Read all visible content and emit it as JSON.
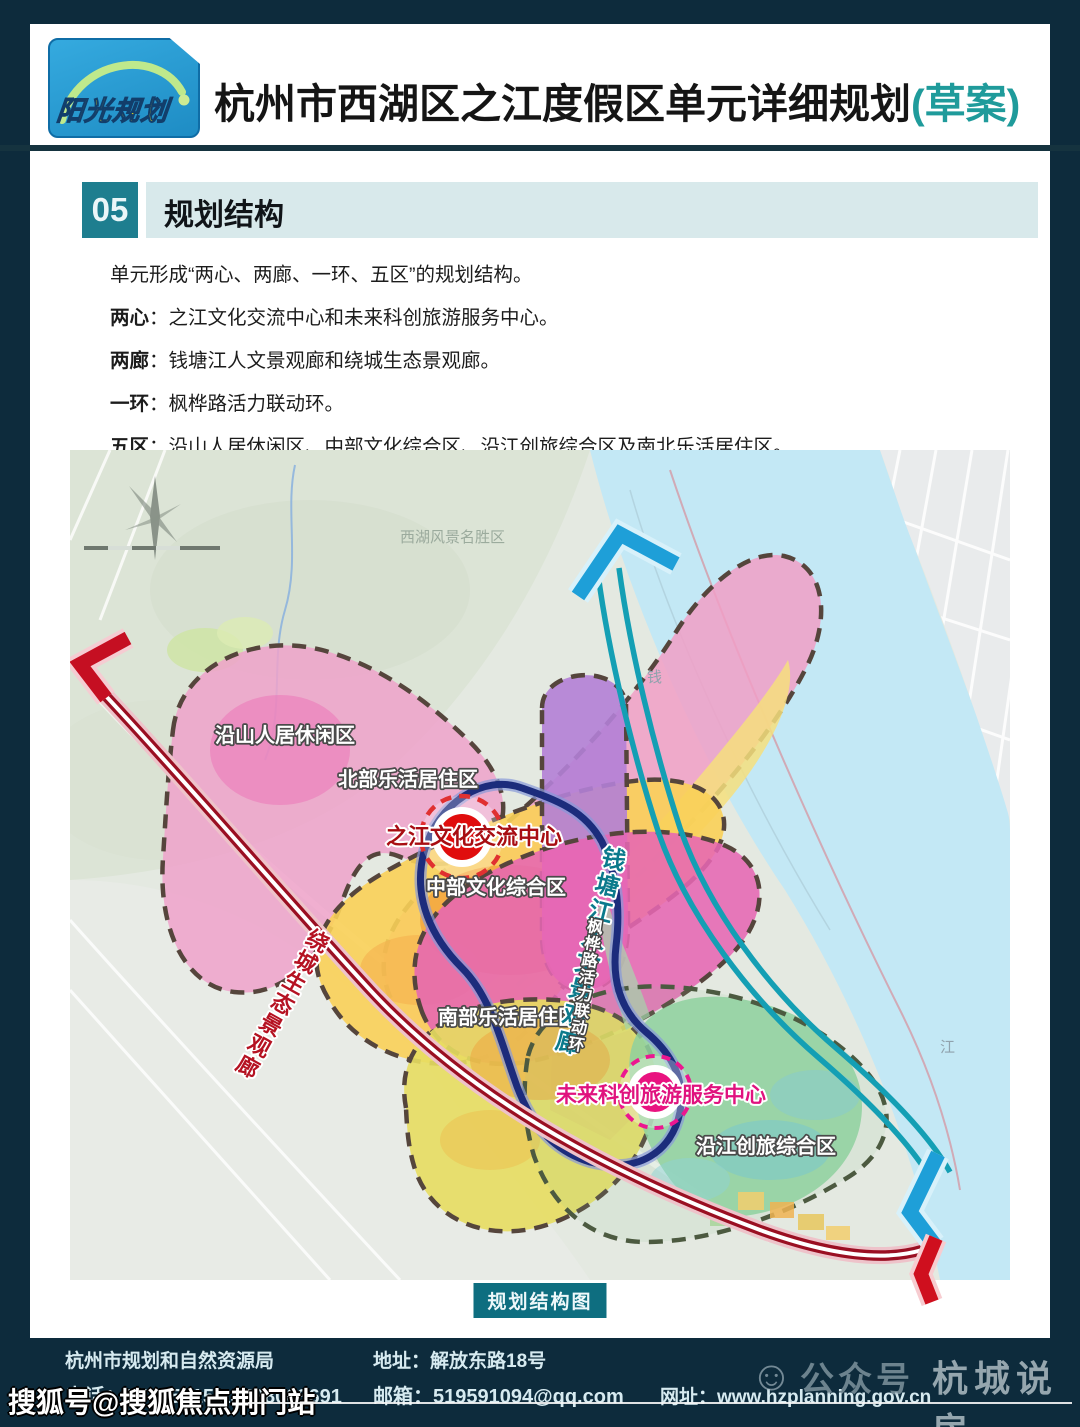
{
  "header": {
    "logo_text": "阳光规划",
    "title": "杭州市西湖区之江度假区单元详细规划",
    "title_suffix": "(草案)"
  },
  "section": {
    "number": "05",
    "title": "规划结构"
  },
  "intro": {
    "line1": "单元形成“两心、两廊、一环、五区”的规划结构。",
    "items": [
      {
        "term": "两心",
        "desc": "：之江文化交流中心和未来科创旅游服务中心。"
      },
      {
        "term": "两廊",
        "desc": "：钱塘江人文景观廊和绕城生态景观廊。"
      },
      {
        "term": "一环",
        "desc": "：枫桦路活力联动环。"
      },
      {
        "term": "五区",
        "desc": "：沿山人居休闲区、中部文化综合区、沿江创旅综合区及南北乐活居住区。"
      }
    ]
  },
  "map": {
    "caption": "规划结构图",
    "labels": {
      "scenic_area": "西湖风景名胜区",
      "river_char1": "钱",
      "river_char2": "江",
      "zone_yanshan": "沿山人居休闲区",
      "zone_beibu": "北部乐活居住区",
      "zone_zhongbu": "中部文化综合区",
      "zone_nanbu": "南部乐活居住区",
      "zone_yanjiang": "沿江创旅综合区",
      "center_zhijiang": "之江文化交流中心",
      "center_weilai": "未来科创旅游服务中心",
      "corridor_qiantang": "钱塘江人文景观廊",
      "corridor_raocheng": "绕城生态景观廊",
      "ring_fenghua": "枫桦路活力联动环"
    },
    "colors": {
      "river": "#c3e8f5",
      "zone_pink": "#f19fc6",
      "zone_yellow": "#f9d058",
      "zone_orange": "#f2a03a",
      "zone_purple": "#b37fd6",
      "zone_magenta": "#e667b3",
      "zone_green": "#8fd2a0",
      "corridor_teal": "#149fb4",
      "ring_navy": "#1c2c7c",
      "road_red": "#9a0f22",
      "center_red": "#e00d0d",
      "center_magenta": "#e91380"
    }
  },
  "footer": {
    "org": "杭州市规划和自然资源局",
    "phone": "电话：87755815   13588003691",
    "address": "地址：解放东路18号",
    "email": "邮箱：519591094@qq.com",
    "website": "网址：www.hzplanning.gov.cn"
  },
  "watermarks": {
    "account_type": "公众号",
    "account_name": "杭城说房",
    "sohu": "搜狐号@搜狐焦点荆门站"
  }
}
